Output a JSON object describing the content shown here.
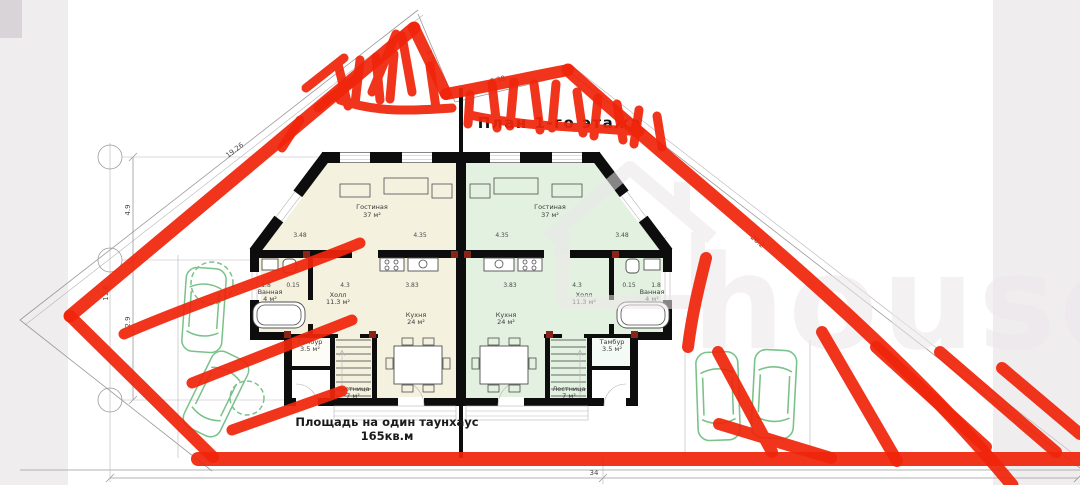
{
  "title": "План 1-го этажа",
  "watermark": "house.kg",
  "footer": {
    "line1": "Площадь на один таунхаус",
    "line2": "165кв.м"
  },
  "rooms": {
    "living": {
      "name": "Гостиная",
      "area": "37 м²"
    },
    "hall": {
      "name": "Холл",
      "area": "11.3 м²"
    },
    "kitchen": {
      "name": "Кухня",
      "area": "24 м²"
    },
    "bath": {
      "name": "Ванная",
      "area": "4 м²"
    },
    "tambour": {
      "name": "Тамбур",
      "area": "3.5 м²"
    },
    "stairs": {
      "name": "Лестница",
      "area": "7 м²"
    }
  },
  "dims": {
    "diag_left": "19.26",
    "notch": "3.78",
    "top_edge": "6.38",
    "diag_right": "26.2",
    "bottom_total": "34",
    "left_1": "4.9",
    "left_2": "11.6",
    "left_3": "2.9",
    "row_1": "3.48",
    "row_2": "4.35",
    "row_3": "4.35",
    "row_4": "3.48",
    "inner_1": "1.8",
    "inner_2": "0.15",
    "inner_3": "4.3",
    "inner_4": "3.83",
    "inner_5": "3.83",
    "inner_6": "4.3",
    "inner_7": "0.15",
    "inner_8": "1.8"
  },
  "icons": {
    "tree": "scalloped-circle-outline",
    "car": "sedan-top-view-outline",
    "watermark_house": "house-outline"
  },
  "colors": {
    "marker_red": "#f0250b",
    "floor_left_unit": "#f4f1df",
    "floor_right_unit": "#e3f1e1",
    "wall_black": "#0d0d0d",
    "greenery": "#79c289",
    "photo_edge_gray": "#f0edef",
    "watermark_gray": "#ece7ea"
  }
}
